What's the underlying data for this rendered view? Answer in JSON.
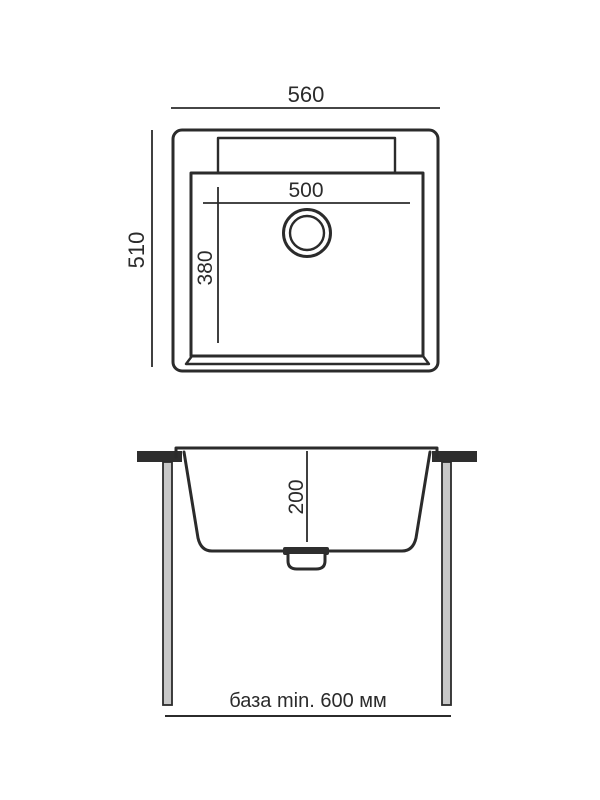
{
  "colors": {
    "line": "#2b2b2b",
    "background": "#ffffff",
    "countertop_fill": "#2e2e2e",
    "leg_fill": "#c8c8c8"
  },
  "top_view": {
    "overall_width": "560",
    "overall_depth": "510",
    "bowl_width": "500",
    "bowl_depth": "380"
  },
  "section_view": {
    "bowl_height": "200",
    "cabinet_note": "база min. 600 мм"
  }
}
